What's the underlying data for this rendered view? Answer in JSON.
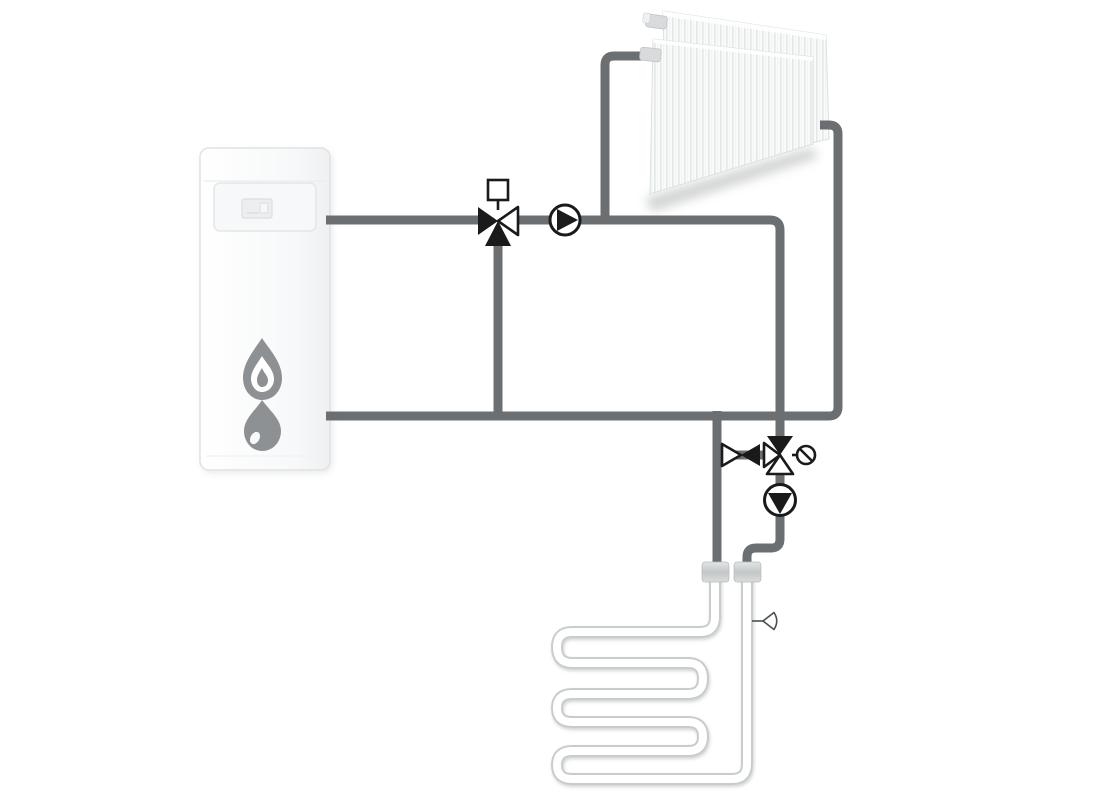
{
  "page": {
    "background": "#ffffff",
    "kind": "hydronic-heating-schematic"
  },
  "colors": {
    "pipe": "#6b6f71",
    "symbol": "#1a1a1a",
    "wpipe": "#c9cccd",
    "gray": "#8d9193",
    "coupling": "#d3d5d6",
    "bg": "#ffffff"
  },
  "diagram": {
    "components": [
      {
        "id": "gas-boiler",
        "icons": [
          "display-icon",
          "flame-icon",
          "water-drop-icon"
        ]
      },
      {
        "id": "panel-radiator",
        "panels": 2
      },
      {
        "id": "three-way-mixing-valve-top",
        "actuator": "square-actuator"
      },
      {
        "id": "circulation-pump-radiator",
        "flow_direction": "right"
      },
      {
        "id": "shutoff-valve-bottom"
      },
      {
        "id": "three-way-mixing-valve-bottom",
        "accessory": "flow-limiter-circle-slash"
      },
      {
        "id": "circulation-pump-floor",
        "flow_direction": "down"
      },
      {
        "id": "pipe-coupling",
        "count": 2
      },
      {
        "id": "underfloor-heating-coil",
        "horizontal_runs": 6
      },
      {
        "id": "temperature-sensor"
      }
    ]
  }
}
